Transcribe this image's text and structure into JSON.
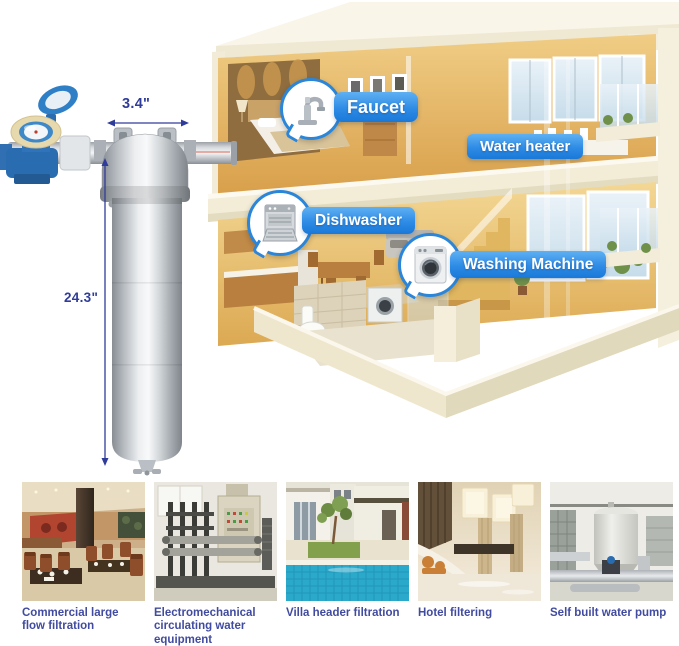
{
  "product": {
    "name": "Stainless steel whole house water filter with water meter",
    "width_dimension": "3.4\"",
    "height_dimension": "24.3\""
  },
  "house_callouts": {
    "faucet": "Faucet",
    "water_heater": "Water heater",
    "dishwasher": "Dishwasher",
    "washing_machine": "Washing Machine"
  },
  "applications": [
    {
      "caption": "Commercial large flow filtration",
      "scene": "restaurant-interior"
    },
    {
      "caption": "Electromechanical circulating water equipment",
      "scene": "water-treatment-equipment-room"
    },
    {
      "caption": "Villa header filtration",
      "scene": "villa-swimming-pool"
    },
    {
      "caption": "Hotel filtering",
      "scene": "hotel-lobby"
    },
    {
      "caption": "Self built water pump",
      "scene": "rooftop-water-pump-tank"
    }
  ],
  "icons": {
    "faucet_bubble": "faucet-icon",
    "dishwasher_bubble": "dishwasher-icon",
    "washing_bubble": "washing-machine-icon"
  },
  "colors": {
    "callout_blue": "#2386e2",
    "caption_text": "#414b9f",
    "dimension_text": "#303c9a",
    "house_wall_gold": "#dfa94e",
    "floor_cream": "#f3ecd6",
    "background": "#ffffff"
  }
}
